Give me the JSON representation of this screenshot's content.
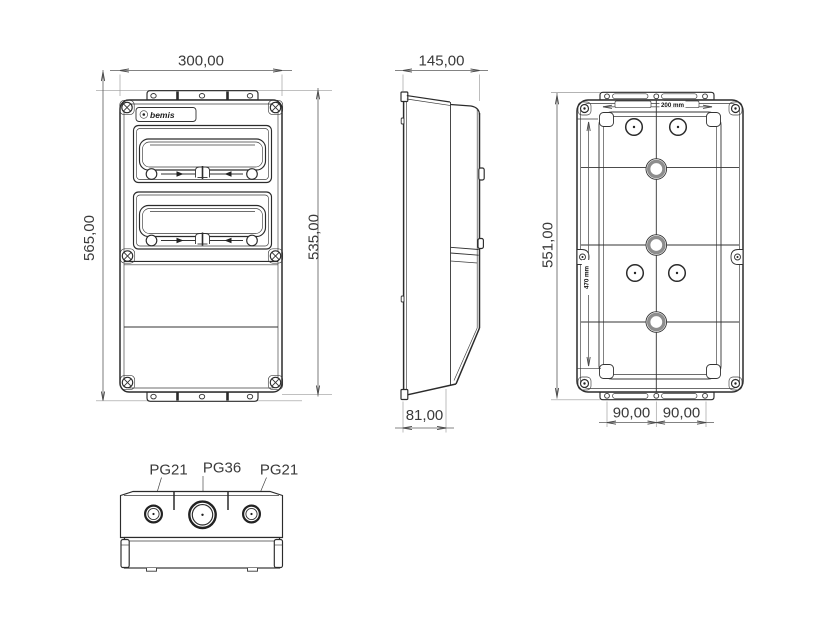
{
  "page": {
    "background": "#ffffff",
    "line_color": "#2b2b2b",
    "dim_text_color": "#3a3a3a"
  },
  "brand": {
    "logo_text": "bemis"
  },
  "views": {
    "front": {
      "title": "front-view",
      "dims": {
        "width": "300,00",
        "overall_height": "565,00",
        "body_height": "535,00"
      }
    },
    "side": {
      "title": "side-view",
      "dims": {
        "depth": "145,00",
        "base_depth": "81,00"
      }
    },
    "rear": {
      "title": "rear-view",
      "dims": {
        "height": "551,00",
        "mount_width": "200 mm",
        "mount_height": "470 mm",
        "bottom_left": "90,00",
        "bottom_right": "90,00"
      }
    },
    "bottom": {
      "title": "bottom-view",
      "glands": {
        "left": "PG21",
        "center": "PG36",
        "right": "PG21"
      }
    }
  }
}
